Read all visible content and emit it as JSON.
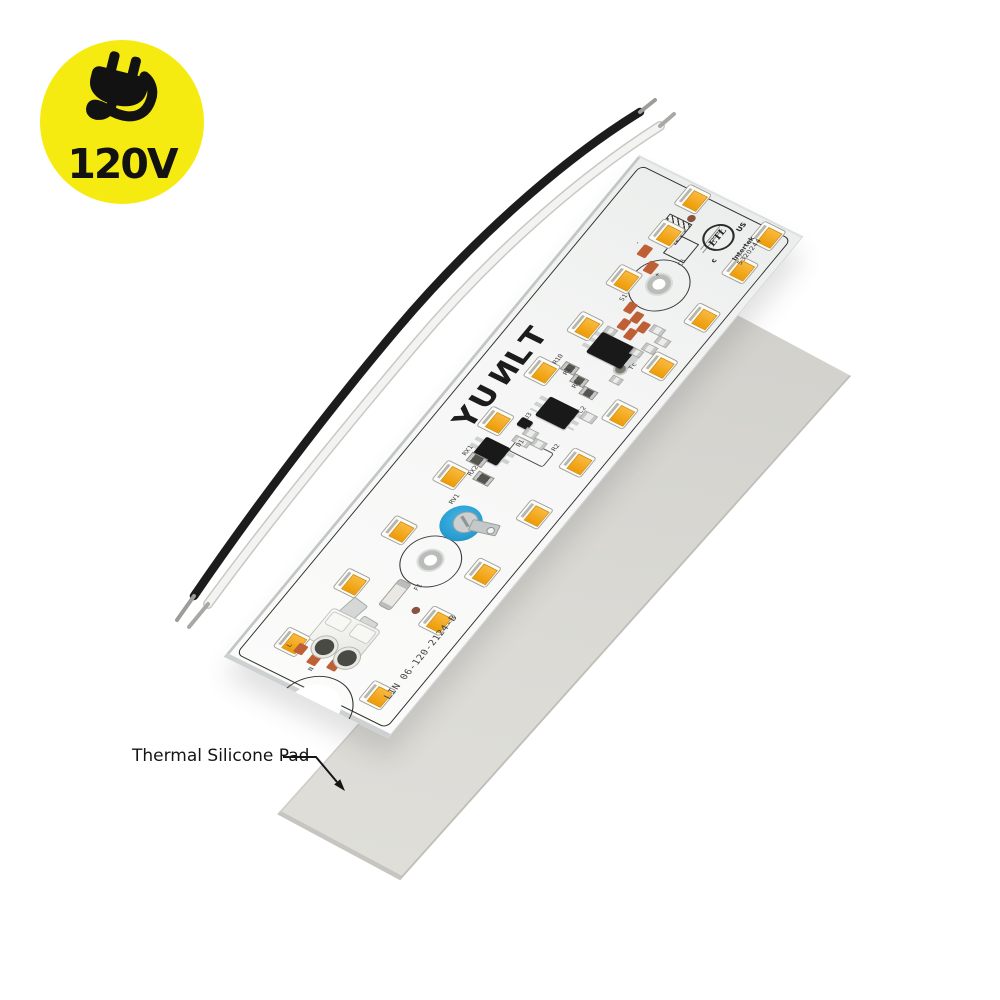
{
  "badge": {
    "voltage": "120V",
    "icon": "plug-icon",
    "bg_color": "#F5EB11",
    "text_color": "#121212"
  },
  "annotation": {
    "label": "Thermal Silicone Pad"
  },
  "thermal_pad": {
    "color": "#D7D6D1"
  },
  "wires": {
    "black_color": "#1C1C1C",
    "white_color": "#F3F3F1"
  },
  "board": {
    "brand": "YUNLT",
    "part_number": "LIN 06-120-2124-B",
    "certification": {
      "mark": "ETL",
      "prefix": "c",
      "suffix": "US",
      "org": "Intertek",
      "number": "5320244"
    },
    "colors": {
      "surface": "#F2F4F3",
      "silkscreen": "#2F2F2D",
      "led_amber": "#EE9C06",
      "copper_pad": "#BF5F36",
      "trimmer_blue": "#2A9FD4"
    },
    "silkscreen_labels": [
      {
        "text": "S1",
        "x": 84,
        "y": 136
      },
      {
        "text": "C5",
        "x": 108,
        "y": 78
      },
      {
        "text": "-",
        "x": 58,
        "y": 80
      },
      {
        "text": "+",
        "x": 96,
        "y": 100
      },
      {
        "text": "Tc",
        "x": 138,
        "y": 194
      },
      {
        "text": "R10",
        "x": 72,
        "y": 221
      },
      {
        "text": "R4",
        "x": 88,
        "y": 228
      },
      {
        "text": "R6",
        "x": 104,
        "y": 236
      },
      {
        "text": "C2",
        "x": 126,
        "y": 256
      },
      {
        "text": "U3",
        "x": 86,
        "y": 286
      },
      {
        "text": "R2",
        "x": 130,
        "y": 302
      },
      {
        "text": "D1",
        "x": 98,
        "y": 314
      },
      {
        "text": "RX1",
        "x": 60,
        "y": 344
      },
      {
        "text": "RX2",
        "x": 78,
        "y": 360
      },
      {
        "text": "RV1",
        "x": 82,
        "y": 394
      },
      {
        "text": "F1",
        "x": 112,
        "y": 490
      },
      {
        "text": "L",
        "x": 46,
        "y": 600
      },
      {
        "text": "N",
        "x": 80,
        "y": 612
      }
    ],
    "leds": [
      [
        74,
        16
      ],
      [
        160,
        16
      ],
      [
        76,
        59
      ],
      [
        160,
        58
      ],
      [
        72,
        119
      ],
      [
        162,
        119
      ],
      [
        72,
        179
      ],
      [
        160,
        182
      ],
      [
        67,
        239
      ],
      [
        160,
        243
      ],
      [
        63,
        305
      ],
      [
        158,
        306
      ],
      [
        63,
        374
      ],
      [
        158,
        372
      ],
      [
        58,
        447
      ],
      [
        155,
        448
      ],
      [
        55,
        516
      ],
      [
        150,
        512
      ],
      [
        46,
        596
      ],
      [
        152,
        606
      ]
    ],
    "holes": [
      {
        "x": 104,
        "y": 108
      },
      {
        "x": 104,
        "y": 460
      }
    ]
  }
}
